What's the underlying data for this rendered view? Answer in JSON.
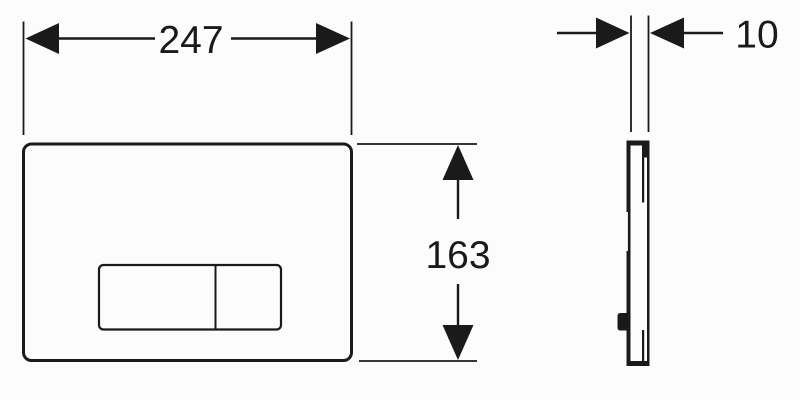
{
  "drawing": {
    "kind": "technical-dimension-diagram",
    "dimensions": {
      "width": {
        "value": "247"
      },
      "height": {
        "value": "163"
      },
      "depth": {
        "value": "10"
      }
    },
    "colors": {
      "ink": "#1a1a1a",
      "background": "#fcfcfc",
      "paper": "#fdfdfd"
    }
  }
}
